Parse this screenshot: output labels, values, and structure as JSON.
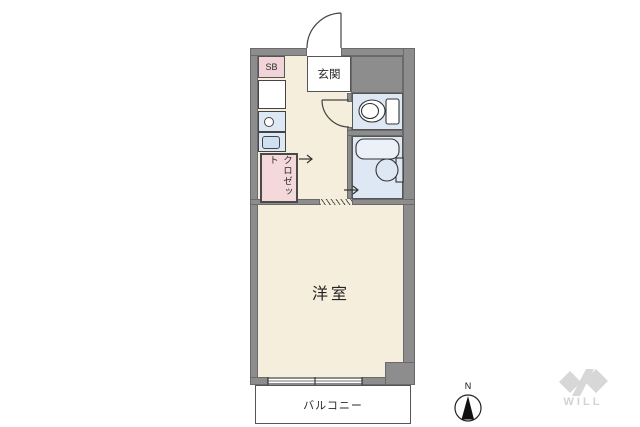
{
  "plan": {
    "rooms": {
      "entrance_label": "玄関",
      "shoe_box_label": "SB",
      "closet_label": "クロゼット",
      "main_room_label": "洋室",
      "balcony_label": "バルコニー"
    },
    "colors": {
      "wall": "#8d8d8d",
      "floor": "#f6eedd",
      "wet_area": "#dde8f4",
      "closet_fill": "#f5d8da",
      "outline": "#444444",
      "background": "#ffffff"
    },
    "icons": {
      "entrance_door": "quarter-arc swing door",
      "toilet": "toilet top view",
      "bathtub": "rounded-rect tub",
      "washbasin": "round basin with counter",
      "stove": "single burner circle",
      "sink": "rounded sink basin",
      "refrigerator_space": "empty white box",
      "closet_door_arrow": "right arrow",
      "sliding_door_arrow": "right arrow",
      "window": "double-line sliding window"
    }
  },
  "compass": {
    "north_label": "N"
  },
  "branding": {
    "logo_text": "WILL",
    "logo_color": "#d7d7d7"
  }
}
